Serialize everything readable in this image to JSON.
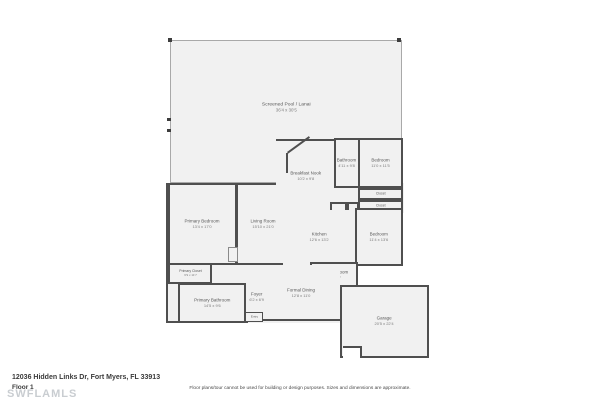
{
  "footer": {
    "address": "12036 Hidden Links Dr, Fort Myers, FL 33913",
    "floor": "Floor 1",
    "watermark": "SWFLAMLS",
    "disclaimer": "Floor plans/tour cannot be used for building or design purposes. Sizes and dimensions are approximate."
  },
  "colors": {
    "wall": "#4f4f4f",
    "room_fill": "#f1f1f1",
    "lanai_border": "#a9a9a9",
    "label_text": "#5a5a5a",
    "watermark_text": "#c9cdd1"
  },
  "rooms": [
    {
      "name": "Screened Pool / Lanai",
      "dims": "36'4 x 30'5"
    },
    {
      "name": "Primary Bedroom",
      "dims": "13'4 x 17'0"
    },
    {
      "name": "Living Room",
      "dims": "15'10 x 21'0"
    },
    {
      "name": "Breakfast Nook",
      "dims": "10'2 x 9'8"
    },
    {
      "name": "Bathroom",
      "dims": "4'11 x 9'8"
    },
    {
      "name": "Bedroom",
      "dims": "11'0 x 11'5"
    },
    {
      "name": "Closet",
      "dims": ""
    },
    {
      "name": "Closet",
      "dims": ""
    },
    {
      "name": "Pantry",
      "dims": ""
    },
    {
      "name": "Closet",
      "dims": ""
    },
    {
      "name": "Kitchen",
      "dims": "12'6 x 13'2"
    },
    {
      "name": "Bedroom",
      "dims": "11'4 x 13'6"
    },
    {
      "name": "Laundry Room",
      "dims": "8'0 x 6'7"
    },
    {
      "name": "Formal Dining",
      "dims": "12'8 x 11'0"
    },
    {
      "name": "Foyer",
      "dims": "6'2 x 6'9"
    },
    {
      "name": "Entry",
      "dims": ""
    },
    {
      "name": "Primary Closet",
      "dims": "6'9 x 11'7"
    },
    {
      "name": "Primary Bathroom",
      "dims": "14'5 x 9'6"
    },
    {
      "name": "Garage",
      "dims": "20'5 x 22'4"
    }
  ]
}
